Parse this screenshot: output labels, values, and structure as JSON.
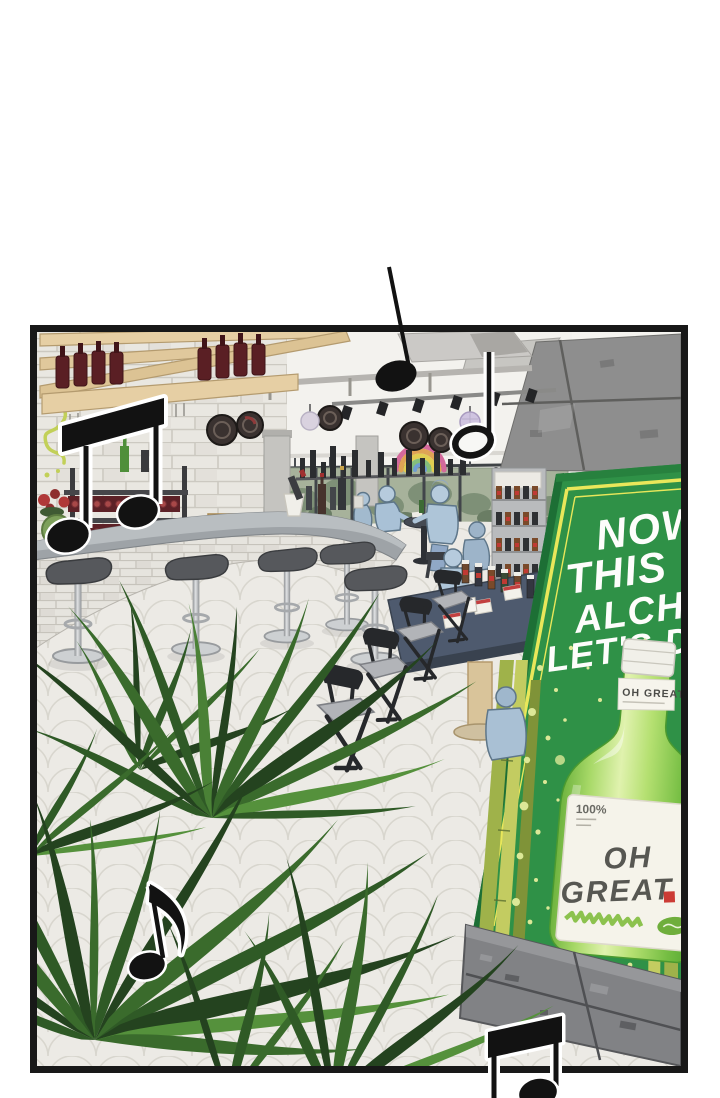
{
  "panel": {
    "kind": "webtoon comic panel",
    "caption": "Pub interior scene with music notes and a soju advertising standee",
    "background_color": "#ffffff",
    "border_color": "#181818"
  },
  "standee": {
    "headline_line1": "NOW",
    "headline_line2": "THIS",
    "headline_line3": "ALCHO",
    "headline_line4": "LET'S DR",
    "panel_color": "#2f9147",
    "frame_color": "#e9e75a",
    "splatter_color": "#dce897"
  },
  "soju_bottle": {
    "neck_label": "OH GREAT",
    "purity_text": "100%",
    "brand_line1": "OH",
    "brand_line2": "GREAT",
    "glass_color": "#7cc24a",
    "accent_red": "#cc3b35",
    "scribble_color": "#8cc24e"
  },
  "scene": {
    "music_note_count": 5,
    "patron_count": 6,
    "stool_count": 5,
    "wall_decal": "rainbow",
    "plant": "palm fronds"
  }
}
